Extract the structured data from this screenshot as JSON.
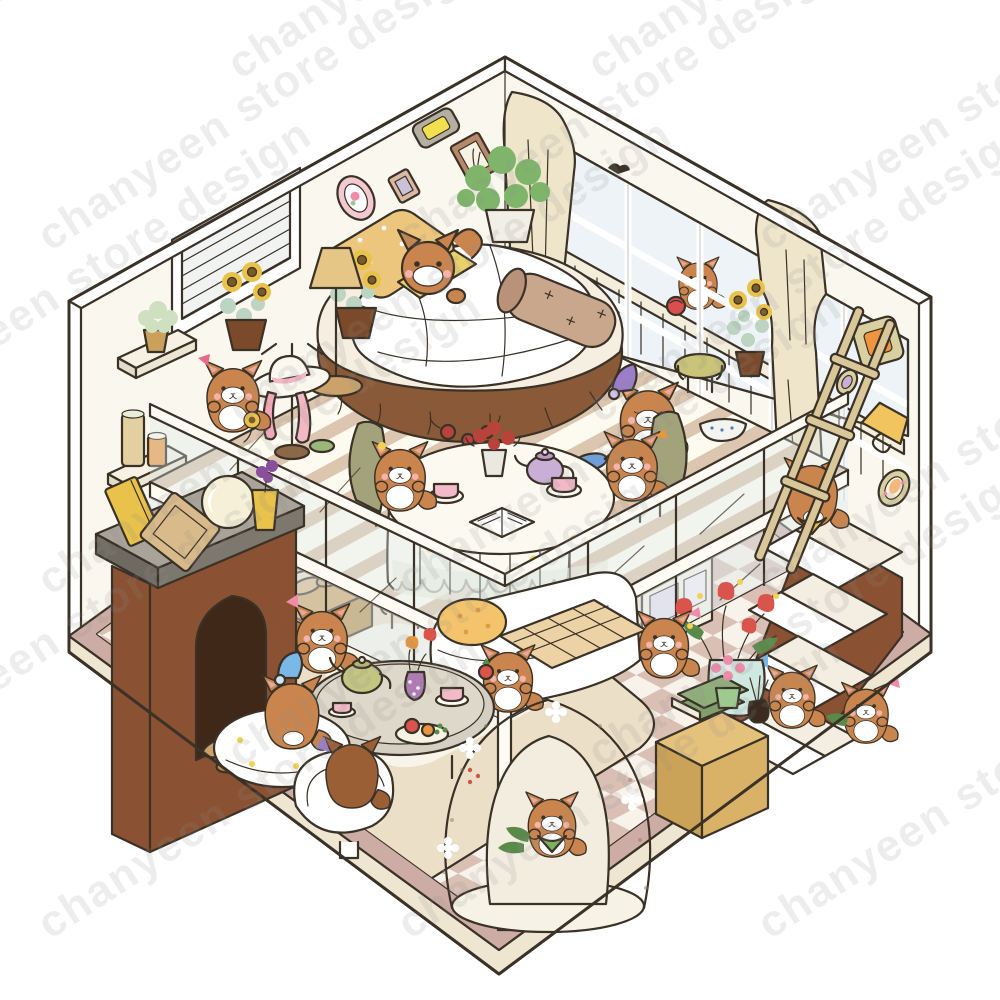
{
  "watermark": {
    "text": "chanyeen store design",
    "color": "#8f8f8f",
    "opacity": 0.16,
    "angle_deg": -33,
    "font_size": 44
  },
  "scene": {
    "type": "isometric-miniature-room-illustration",
    "subject": "kawaii shiba-cat dollhouse cutaway with loft bedroom above and living room below",
    "cat_count": 15,
    "objects": [
      "round-pet-bed",
      "quilted-mattress",
      "polka-dot-pillow",
      "bolster-pillow",
      "potted-plant",
      "big-window-with-balcony",
      "balcony-cat-with-red-ball",
      "bird-on-window",
      "cream-curtains",
      "left-window-shutters",
      "sunflower-planters",
      "floor-lamp",
      "hat-stand-with-sun-hat",
      "glass-loft-railing",
      "striped-wood-loft-floor",
      "tea-table-with-skirted-cloth",
      "purple-teapot",
      "pink-teacups",
      "rose-vase",
      "open-book",
      "olive-armchairs",
      "sleeping-cat-with-nightcap",
      "fish-toy",
      "boat-dish",
      "loft-stool",
      "wall-frames",
      "wall-shelf-succulent",
      "wall-shelf-candles",
      "brick-fireplace",
      "mantel-books",
      "mantel-plate",
      "mantel-flower-cup",
      "firewood-crate",
      "green-stool",
      "white-sofa-with-waffle-blanket",
      "orange-dot-cushion",
      "oval-coffee-table",
      "green-teapot",
      "tulip-bud-vase",
      "fruit-plate",
      "donut-pouf",
      "white-tub-chair",
      "lace-canopy-tent",
      "tent-cat-with-green-bandana",
      "wooden-side-table",
      "book-stack",
      "pink-flower-pot",
      "reed-diffuser",
      "brick-staircase",
      "stair-cats",
      "wooden-ladder",
      "wall-sconce-lamp",
      "mint-tulip-planter",
      "checkered-tile-floor",
      "cream-rug"
    ]
  },
  "palette": {
    "background": "#ffffff",
    "outline": "#3a3127",
    "wall": "#faf7ee",
    "floor_wood": "#fdfaf0",
    "floor_stripe": "#dcc6b0",
    "tile_light": "#f8f3ea",
    "tile_mauve": "#d9bfb4",
    "rug_cream": "#ecdfc7",
    "brick": "#8a5132",
    "brick_mortar": "#5e331c",
    "mantel_gray": "#a9a49a",
    "cat_body": "#c9854d",
    "cat_belly": "#ffffff",
    "cat_cheek": "#f4b3ac",
    "bed_base": "#8a5a38",
    "pillow": "#ecc67c",
    "bolster": "#c9a78c",
    "curtain": "#efe5cb",
    "glass": "#dfe9ec",
    "rail_white": "#fdfbf4",
    "waffle_blanket": "#ecd2a4",
    "cushion_orange": "#f4c46c",
    "teapot_purple": "#c9aed6",
    "teapot_green": "#c5c583",
    "teacup_pink": "#f2b9c9",
    "tent_lace": "#cfc2b0",
    "side_table": "#e5c27c",
    "stair_step": "#f3eee1",
    "step_trim": "#f4c9d2",
    "ladder": "#d9c79a",
    "lamp_shade": "#e6c687",
    "sconce_yellow": "#f2c45f",
    "plant_green": "#7fb56a",
    "sunflower": "#e8c24a",
    "tulip_red": "#d9544a",
    "planter_mint": "#cfe8e0"
  }
}
